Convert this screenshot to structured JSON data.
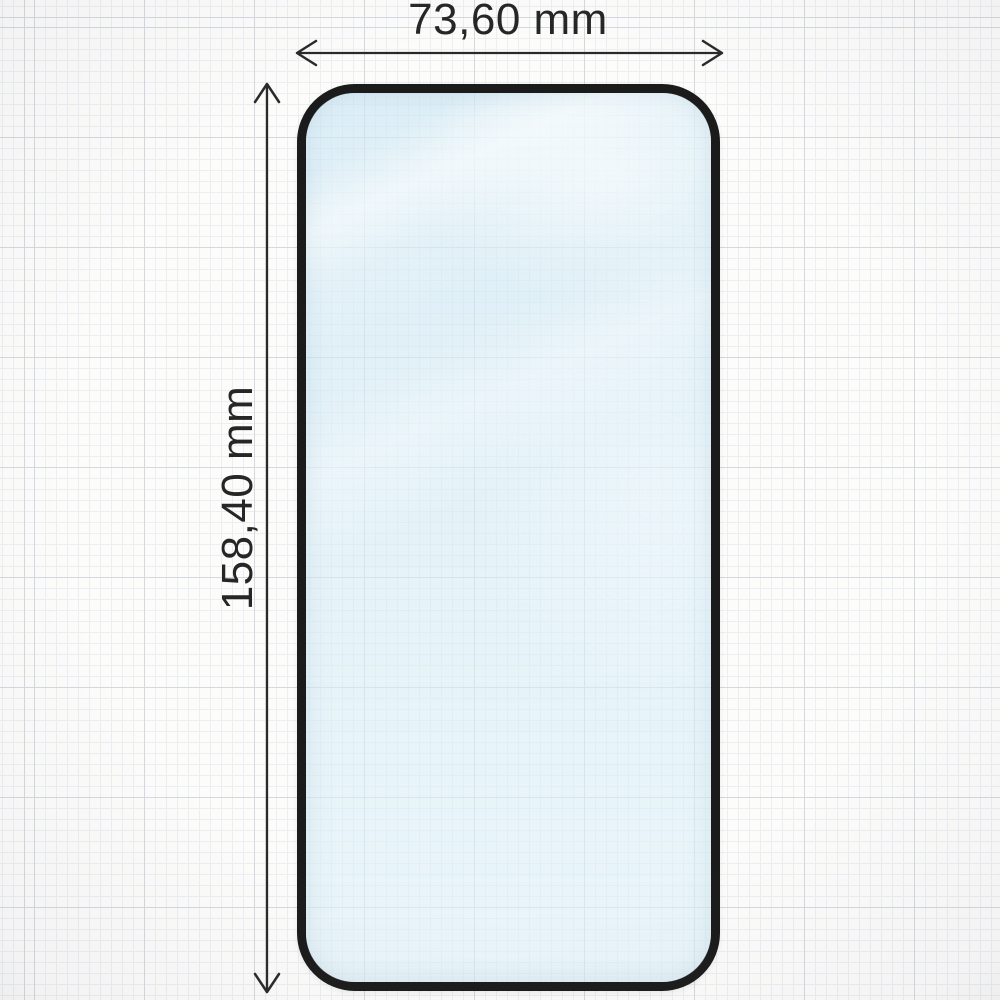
{
  "labels": {
    "width": "73,60 mm",
    "height": "158,40 mm"
  },
  "colors": {
    "paper": "#fcfcfb",
    "grid_minor": "#eceef2",
    "grid_major": "#d5d8de",
    "protector_border": "#1b1b1b",
    "glass_tint": "#d5ecf6",
    "dimension": "#2a2a2a",
    "label_text": "#262626"
  }
}
